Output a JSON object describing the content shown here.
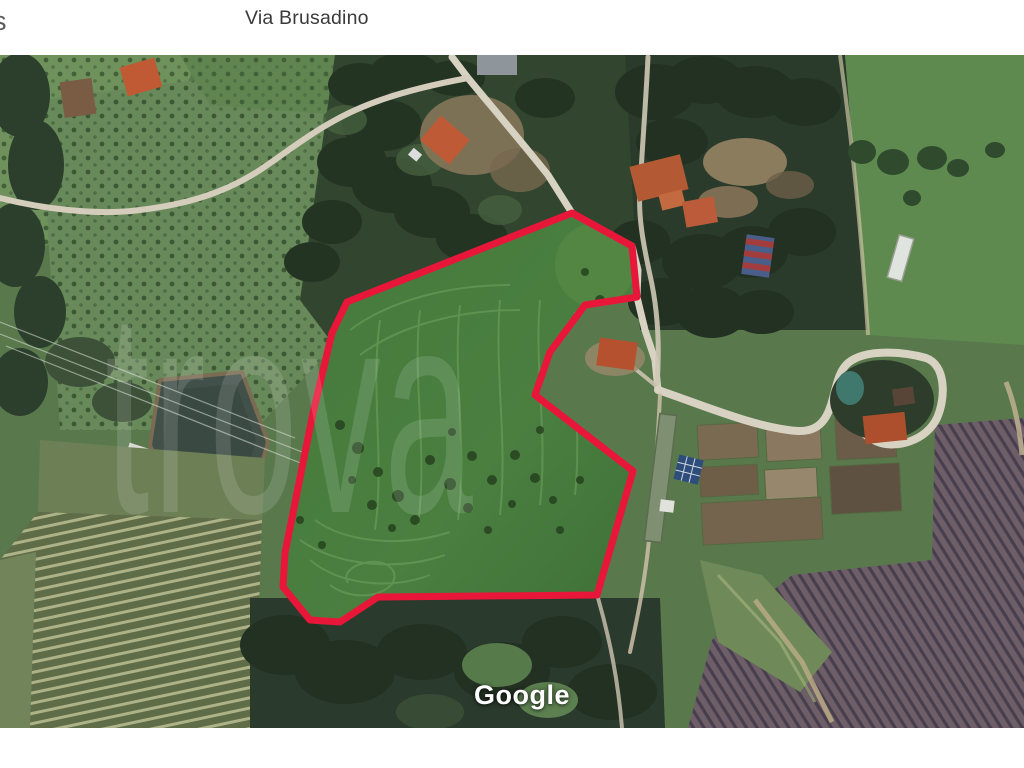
{
  "header": {
    "partial_left_text": "s",
    "street_label": "Via Brusadino"
  },
  "map": {
    "watermark_text": "trova",
    "attribution_logo": "Google",
    "parcel_outline_color": "#e8173a",
    "parcel_points": [
      [
        572,
        213
      ],
      [
        632,
        246
      ],
      [
        637,
        297
      ],
      [
        585,
        305
      ],
      [
        550,
        352
      ],
      [
        535,
        395
      ],
      [
        633,
        471
      ],
      [
        597,
        595
      ],
      [
        378,
        597
      ],
      [
        340,
        622
      ],
      [
        310,
        620
      ],
      [
        283,
        587
      ],
      [
        285,
        553
      ],
      [
        313,
        413
      ],
      [
        332,
        333
      ],
      [
        347,
        302
      ]
    ]
  }
}
